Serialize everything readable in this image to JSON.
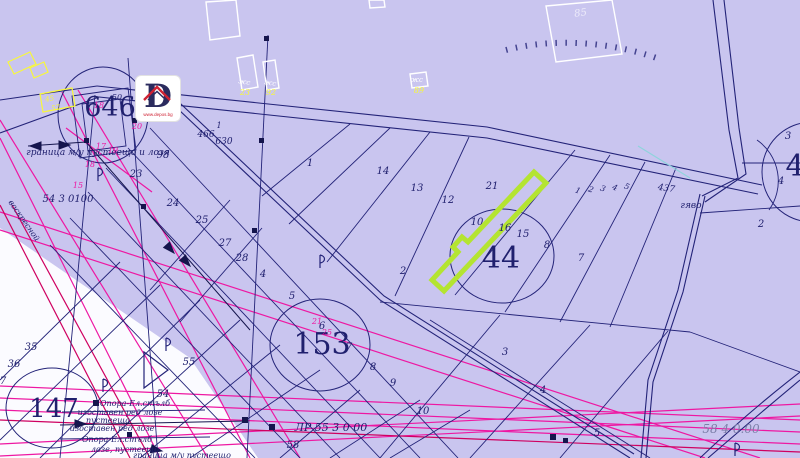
{
  "colors": {
    "bg": "#c9c5ef",
    "white_area": "#fbfbff",
    "navy": "#232378",
    "text": "#20206e",
    "pink": "#ee17a2",
    "crimson": "#cf0060",
    "green_highlight": "#b4e431",
    "yellow": "#f8f83a",
    "white": "#ffffff",
    "grey": "#7c7fa8",
    "red": "#cf2233",
    "cyan": "#8fd4dc"
  },
  "logo": {
    "letter": "D",
    "url": "www.depos.bg"
  },
  "boundary_note": "граница м/у пустеещо и лозя",
  "legend_lines": [
    "Опора-Ел.стълб",
    "изоставен ред лозе",
    "пустееща",
    "изоставен ред лозе",
    "Опора-Ел.стълб",
    "лозе, пустеещо",
    "граница м/у пустеещо"
  ],
  "highlighted_parcel": {
    "adjacent_numbers": [
      "10",
      "16",
      "21"
    ],
    "zone": "44"
  },
  "labels": [
    {
      "t": "646",
      "x": 110,
      "y": 116,
      "s": 27,
      "i": false,
      "n": "zone-number-646"
    },
    {
      "t": "44",
      "x": 501,
      "y": 268,
      "s": 30,
      "i": false,
      "n": "zone-number-44"
    },
    {
      "t": "153",
      "x": 322,
      "y": 354,
      "s": 30,
      "i": false,
      "n": "zone-number-153"
    },
    {
      "t": "147",
      "x": 54,
      "y": 417,
      "s": 26,
      "i": false,
      "n": "zone-number-147"
    },
    {
      "t": "4",
      "x": 795,
      "y": 176,
      "s": 30,
      "i": false,
      "n": "zone-number-right"
    },
    {
      "t": "граница м/у пустеещо и лозя",
      "x": 98,
      "y": 155,
      "s": 9,
      "n": "boundary-note"
    },
    {
      "t": "54 3 0100",
      "x": 68,
      "y": 202,
      "s": 10,
      "n": "coordinate-label"
    },
    {
      "t": "ЛР 55 3 0 00",
      "x": 331,
      "y": 431,
      "s": 11,
      "n": "coordinate-label"
    },
    {
      "t": "58 4 0.00",
      "x": 731,
      "y": 433,
      "s": 12,
      "c": "grey",
      "n": "coordinate-label"
    },
    {
      "t": "Опора-Ел.стълб",
      "x": 135,
      "y": 406,
      "s": 8,
      "n": "legend-label"
    },
    {
      "t": "изоставен ред лозе",
      "x": 120,
      "y": 415,
      "s": 8,
      "n": "legend-label"
    },
    {
      "t": "пустееща",
      "x": 108,
      "y": 423,
      "s": 8,
      "n": "legend-label"
    },
    {
      "t": "изоставен ред лозе",
      "x": 112,
      "y": 431,
      "s": 8,
      "n": "legend-label"
    },
    {
      "t": "Опора-Ел.стълб",
      "x": 117,
      "y": 442,
      "s": 8,
      "n": "legend-label"
    },
    {
      "t": "лозе, пустеещо",
      "x": 125,
      "y": 452,
      "s": 8,
      "n": "legend-label"
    },
    {
      "t": "граница м/у пустеещо",
      "x": 182,
      "y": 458,
      "s": 8,
      "n": "legend-label"
    },
    {
      "t": "воскресной",
      "x": 22,
      "y": 222,
      "s": 8,
      "r": 55,
      "n": "road-name"
    },
    {
      "t": "466",
      "x": 206,
      "y": 137,
      "s": 9
    },
    {
      "t": "630",
      "x": 224,
      "y": 144,
      "s": 9
    },
    {
      "t": "1",
      "x": 219,
      "y": 128,
      "s": 8
    },
    {
      "t": "437",
      "x": 666,
      "y": 191,
      "s": 9,
      "r": 8,
      "n": "road-number"
    },
    {
      "t": "гяво",
      "x": 691,
      "y": 208,
      "s": 9,
      "n": "place-name"
    },
    {
      "t": "1",
      "x": 310,
      "y": 166
    },
    {
      "t": "14",
      "x": 383,
      "y": 174
    },
    {
      "t": "13",
      "x": 417,
      "y": 191
    },
    {
      "t": "12",
      "x": 448,
      "y": 203
    },
    {
      "t": "21",
      "x": 492,
      "y": 189
    },
    {
      "t": "10",
      "x": 477,
      "y": 225
    },
    {
      "t": "16",
      "x": 505,
      "y": 231
    },
    {
      "t": "15",
      "x": 523,
      "y": 237
    },
    {
      "t": "8",
      "x": 547,
      "y": 248
    },
    {
      "t": "7",
      "x": 581,
      "y": 261
    },
    {
      "t": "3",
      "x": 788,
      "y": 139
    },
    {
      "t": "4",
      "x": 781,
      "y": 184
    },
    {
      "t": "2",
      "x": 761,
      "y": 227
    },
    {
      "t": "2",
      "x": 403,
      "y": 274
    },
    {
      "t": "98",
      "x": 163,
      "y": 158
    },
    {
      "t": "24",
      "x": 173,
      "y": 206
    },
    {
      "t": "25",
      "x": 202,
      "y": 223
    },
    {
      "t": "27",
      "x": 225,
      "y": 246
    },
    {
      "t": "28",
      "x": 242,
      "y": 261
    },
    {
      "t": "4",
      "x": 263,
      "y": 277
    },
    {
      "t": "5",
      "x": 292,
      "y": 299
    },
    {
      "t": "6",
      "x": 322,
      "y": 329
    },
    {
      "t": "7",
      "x": 349,
      "y": 350
    },
    {
      "t": "8",
      "x": 373,
      "y": 370
    },
    {
      "t": "9",
      "x": 393,
      "y": 386
    },
    {
      "t": "23",
      "x": 136,
      "y": 177
    },
    {
      "t": "35",
      "x": 31,
      "y": 350
    },
    {
      "t": "36",
      "x": 14,
      "y": 367
    },
    {
      "t": "7",
      "x": 3,
      "y": 384
    },
    {
      "t": "54",
      "x": 163,
      "y": 397
    },
    {
      "t": "55",
      "x": 189,
      "y": 365
    },
    {
      "t": "3",
      "x": 505,
      "y": 355
    },
    {
      "t": "4",
      "x": 543,
      "y": 393
    },
    {
      "t": "5",
      "x": 597,
      "y": 436
    },
    {
      "t": "10",
      "x": 423,
      "y": 414
    },
    {
      "t": "58",
      "x": 293,
      "y": 448
    },
    {
      "t": "50",
      "x": 117,
      "y": 100,
      "s": 8
    },
    {
      "t": "1",
      "x": 577,
      "y": 193,
      "s": 8,
      "r": 20
    },
    {
      "t": "2",
      "x": 590,
      "y": 192,
      "s": 8,
      "r": 20
    },
    {
      "t": "3",
      "x": 602,
      "y": 191,
      "s": 8,
      "r": 20
    },
    {
      "t": "4",
      "x": 614,
      "y": 190,
      "s": 8,
      "r": 20
    },
    {
      "t": "5",
      "x": 626,
      "y": 189,
      "s": 8,
      "r": 20
    },
    {
      "t": "18",
      "x": 99,
      "y": 108,
      "s": 8,
      "c": "pink"
    },
    {
      "t": "20",
      "x": 137,
      "y": 129,
      "s": 8,
      "c": "pink"
    },
    {
      "t": "17",
      "x": 101,
      "y": 149,
      "s": 8,
      "c": "pink"
    },
    {
      "t": "19",
      "x": 113,
      "y": 153,
      "s": 8,
      "c": "pink"
    },
    {
      "t": "18",
      "x": 90,
      "y": 167,
      "s": 8,
      "c": "pink"
    },
    {
      "t": "15",
      "x": 78,
      "y": 188,
      "s": 8,
      "c": "pink"
    },
    {
      "t": "21",
      "x": 317,
      "y": 324,
      "s": 8,
      "c": "pink"
    },
    {
      "t": "25",
      "x": 327,
      "y": 335,
      "s": 8,
      "c": "pink"
    },
    {
      "t": "85",
      "x": 581,
      "y": 16,
      "s": 10,
      "c": "white",
      "r": -8,
      "o": 0.65,
      "n": "building-number"
    },
    {
      "t": "жс",
      "x": 244,
      "y": 84,
      "s": 7,
      "c": "white",
      "r": 10,
      "n": "building-type"
    },
    {
      "t": "жс",
      "x": 270,
      "y": 85,
      "s": 7,
      "c": "white",
      "r": 10,
      "n": "building-type"
    },
    {
      "t": "жс",
      "x": 417,
      "y": 82,
      "s": 7,
      "c": "white",
      "n": "building-type"
    },
    {
      "t": "23",
      "x": 245,
      "y": 95,
      "s": 8,
      "c": "yellow",
      "n": "building-number"
    },
    {
      "t": "92",
      "x": 271,
      "y": 95,
      "s": 8,
      "c": "yellow",
      "n": "building-number"
    },
    {
      "t": "89",
      "x": 419,
      "y": 93,
      "s": 8,
      "c": "yellow",
      "n": "building-number"
    },
    {
      "t": "45",
      "x": 50,
      "y": 101,
      "s": 7,
      "c": "yellow",
      "r": -10,
      "n": "building-number"
    },
    {
      "t": "57",
      "x": 56,
      "y": 110,
      "s": 7,
      "c": "yellow",
      "r": -10,
      "n": "building-number"
    }
  ]
}
